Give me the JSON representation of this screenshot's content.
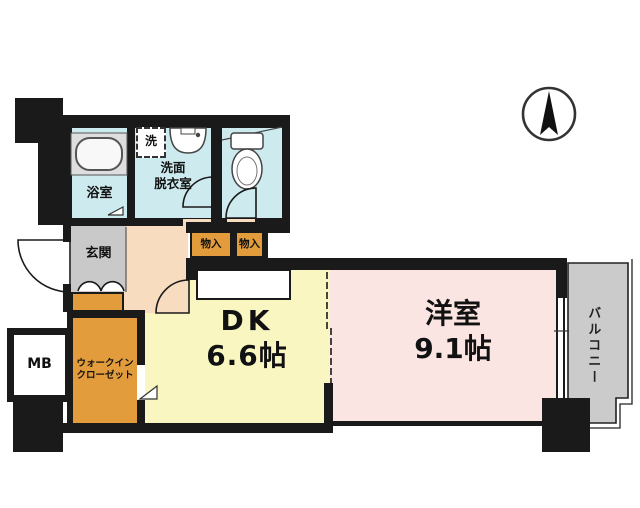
{
  "plan_title": "1DK apartment floor plan",
  "compass": {
    "icon": "north-arrow"
  },
  "rooms": {
    "bathroom": {
      "label": "浴室"
    },
    "washroom": {
      "line1": "洗面",
      "line2": "脱衣室"
    },
    "washing_machine": {
      "label": "洗"
    },
    "entrance": {
      "label": "玄関"
    },
    "storage_1": {
      "label": "物入"
    },
    "storage_2": {
      "label": "物入"
    },
    "walk_in_closet": {
      "line1": "ウォークイン",
      "line2": "クローゼット"
    },
    "meter_box": {
      "label": "MB"
    },
    "dining_kitchen": {
      "label": "DK",
      "size": "6.6帖"
    },
    "western_room": {
      "label": "洋室",
      "size": "9.1帖"
    },
    "balcony": {
      "label": "バルコニー"
    }
  },
  "colors": {
    "wall": "#1a1a1a",
    "wet_area_floor": "#cdeaee",
    "hall_floor": "#f7dcc0",
    "dk_floor": "#f9f6c2",
    "western_room_floor": "#fae5e3",
    "closet_fill": "#e39c3c",
    "entrance_fill": "#c9c9c9",
    "balcony_fill": "#cbcbcb"
  }
}
